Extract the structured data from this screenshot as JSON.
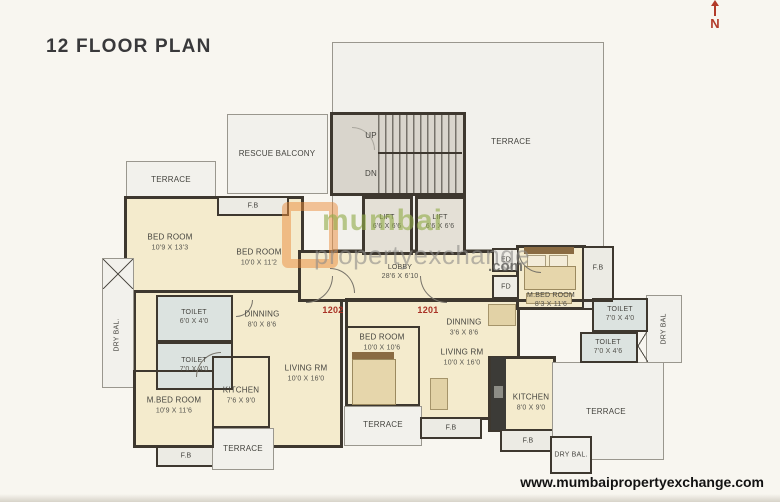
{
  "title": "12 FLOOR PLAN",
  "compass": {
    "north": "N"
  },
  "footer": {
    "url": "www.mumbaipropertyexchange.com"
  },
  "watermark": {
    "brand_first": "mumbai",
    "brand_second": "propertyexchange",
    "brand_suffix": ".com"
  },
  "units": {
    "left_flat_no": "1202",
    "right_flat_no": "1201"
  },
  "stairs": {
    "up": "UP",
    "down": "DN"
  },
  "colors": {
    "accent_red": "#a93226",
    "wall": "#3e382f",
    "room_cream": "#f4ebcd",
    "toilet_grey": "#dce3e0",
    "watermark_green": "#93ad4b",
    "watermark_orange": "#e98b3c"
  },
  "rooms": {
    "terrace_tl": {
      "label": "TERRACE"
    },
    "fb_tl": {
      "label": "F.B"
    },
    "bedroom_l1": {
      "label": "BED ROOM",
      "dims": "10'9 X 13'3"
    },
    "bedroom_l2": {
      "label": "BED ROOM",
      "dims": "10'0 X 11'2"
    },
    "drybal_l": {
      "label": "DRY BAL."
    },
    "toilet_l1": {
      "label": "TOILET",
      "dims": "6'0 X 4'0"
    },
    "toilet_l2": {
      "label": "TOILET",
      "dims": "7'0 X 4'0"
    },
    "dinning_l": {
      "label": "DINNING",
      "dims": "8'0 X 8'6"
    },
    "mbed_l": {
      "label": "M.BED ROOM",
      "dims": "10'9 X 11'6"
    },
    "kitchen_l": {
      "label": "KITCHEN",
      "dims": "7'6 X 9'0"
    },
    "living_l": {
      "label": "LIVING RM",
      "dims": "10'0 X 16'0"
    },
    "fb_bl": {
      "label": "F.B"
    },
    "terrace_bcl": {
      "label": "TERRACE"
    },
    "rescue_balcony": {
      "label": "RESCUE BALCONY"
    },
    "terrace_top": {
      "label": "TERRACE"
    },
    "lift1": {
      "label": "LIFT",
      "dims": "6'6 X 6'6"
    },
    "lift2": {
      "label": "LIFT",
      "dims": "6'6 X 6'6"
    },
    "lobby": {
      "label": "LOBBY",
      "dims": "28'6 X 6'10"
    },
    "shaft_ed": {
      "label": "ED"
    },
    "shaft_fd": {
      "label": "FD"
    },
    "bedroom_bc": {
      "label": "BED ROOM",
      "dims": "10'0 X 10'6"
    },
    "terrace_bc": {
      "label": "TERRACE"
    },
    "fb_bc": {
      "label": "F.B"
    },
    "dinning_r": {
      "label": "DINNING",
      "dims": "3'6 X 8'6"
    },
    "living_r": {
      "label": "LIVING RM",
      "dims": "10'0 X 16'0"
    },
    "mbed_r": {
      "label": "M.BED ROOM",
      "dims": "8'3 X 11'6"
    },
    "fb_r": {
      "label": "F.B"
    },
    "toilet_r1": {
      "label": "TOILET",
      "dims": "7'0 X 4'0"
    },
    "toilet_r2": {
      "label": "TOILET",
      "dims": "7'0 X 4'6"
    },
    "drybal_r": {
      "label": "DRY BAL"
    },
    "kitchen_r": {
      "label": "KITCHEN",
      "dims": "8'0 X 9'0"
    },
    "fb_kr": {
      "label": "F.B"
    },
    "terrace_br": {
      "label": "TERRACE"
    },
    "drybal_br": {
      "label": "DRY BAL."
    }
  }
}
